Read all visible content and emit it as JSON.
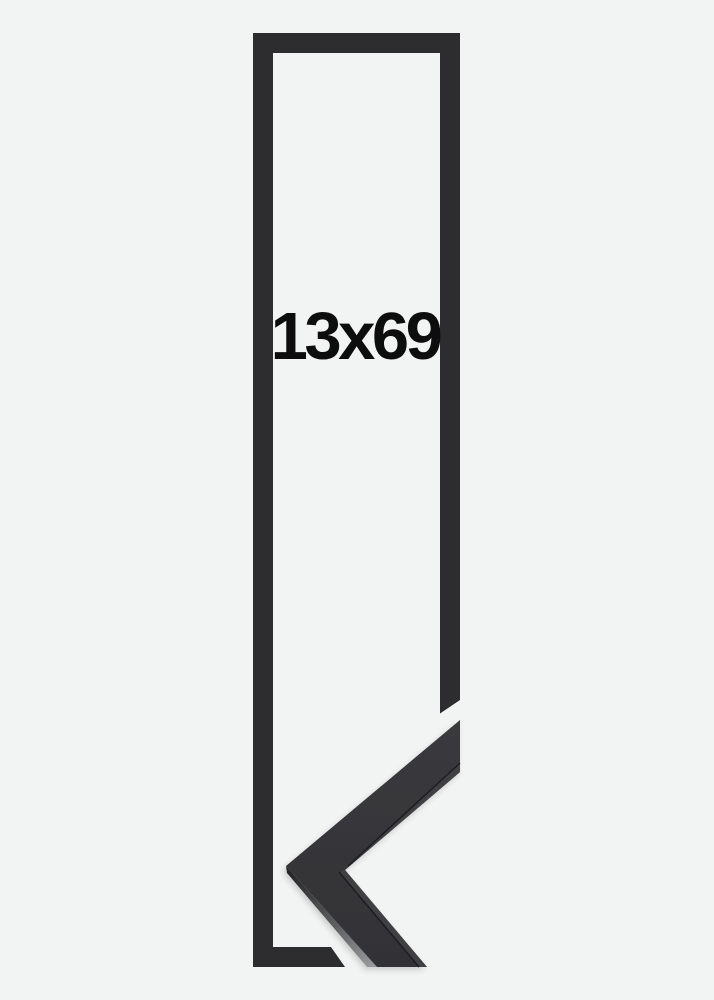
{
  "product_image": {
    "size_label": "13x69",
    "background_color": "#f2f3f3",
    "colors": {
      "outline": "#2d2d2f",
      "sample_face_top": "#3a3a3d",
      "sample_face_bottom": "#323236",
      "sample_inner_band": "#404043",
      "sample_crease": "#1e1e20",
      "sample_side_dark": "#28282a",
      "sample_side_light": "#97989a",
      "label_text": "#0d0d0d"
    }
  }
}
